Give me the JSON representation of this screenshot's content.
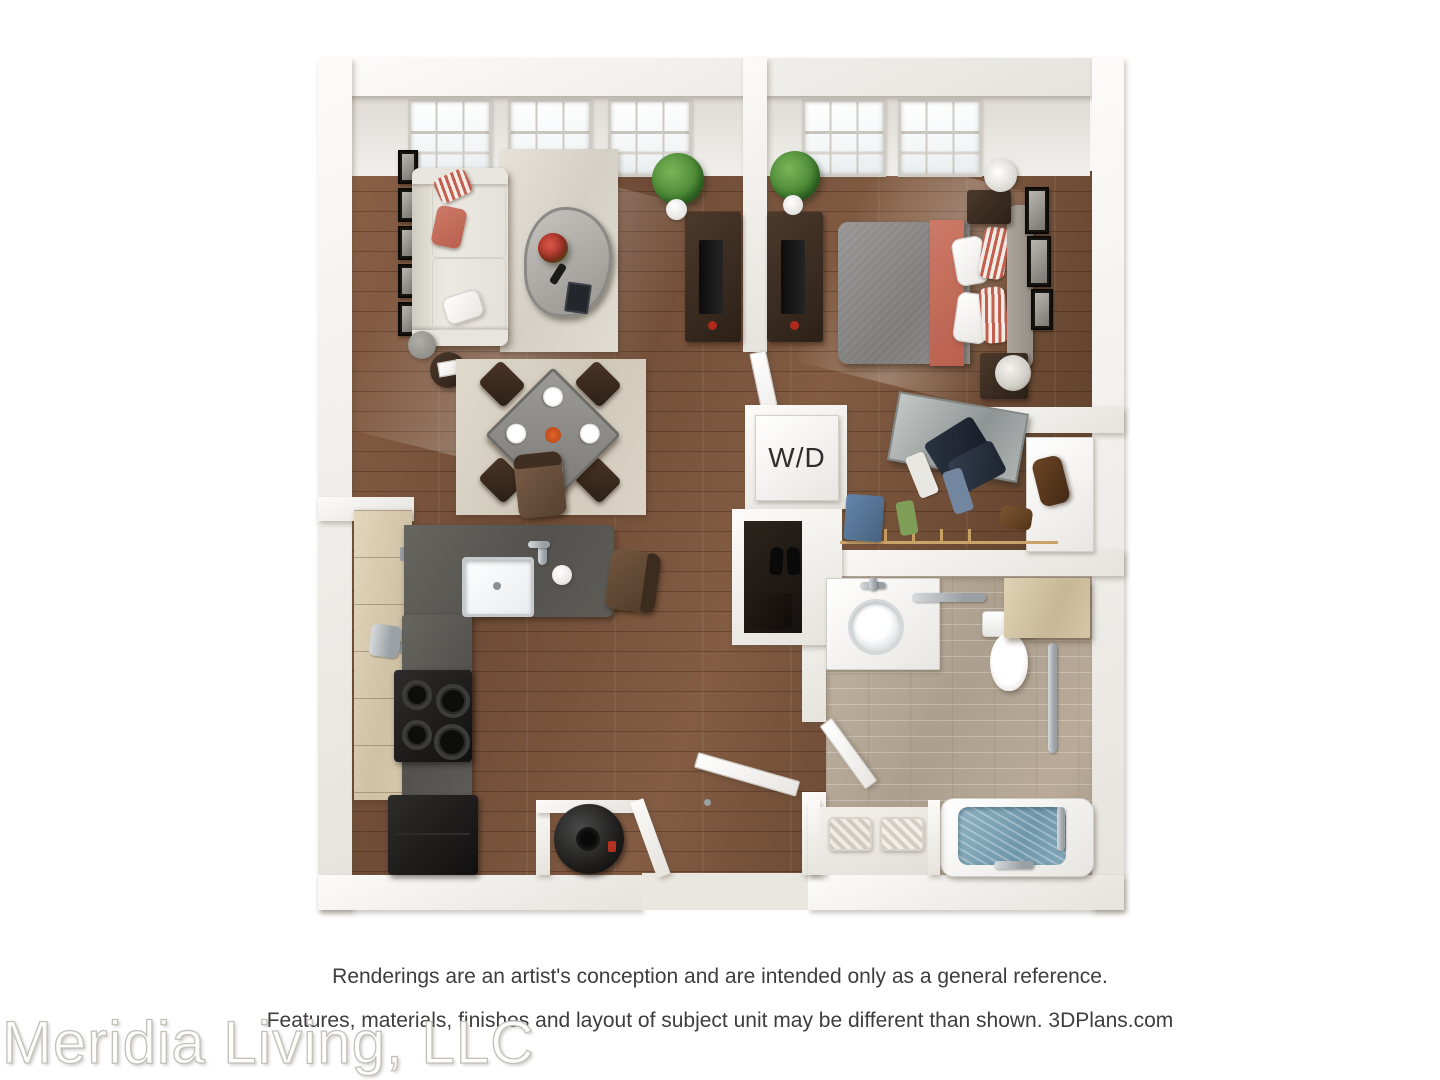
{
  "watermark": "Meridia Living, LLC",
  "disclaimer": {
    "line1": "Renderings are an artist's conception and are intended only as a general reference.",
    "line2": "Features, materials, finishes and layout of subject unit may be different than shown. 3DPlans.com"
  },
  "plan": {
    "labels": {
      "washer_dryer": "W/D"
    },
    "view": "3D top-down apartment floor plan rendering, one bedroom / one bathroom unit",
    "rooms": [
      "living room",
      "dining area",
      "kitchen",
      "bedroom",
      "hallway",
      "walk-in closet",
      "coat closet",
      "laundry closet",
      "bathroom",
      "linen closet",
      "water heater closet",
      "entry"
    ],
    "furniture": [
      "sofa with coral pillow",
      "glass coffee table with red flowers",
      "living room rug",
      "round side table",
      "gallery wall frames",
      "dining table with four chairs and place settings",
      "dining rug",
      "two potted plants",
      "tv console living side",
      "tv console bedroom side",
      "queen bed with gray duvet and coral runner",
      "upholstered headboard",
      "two nightstands with lamps",
      "three wall frames",
      "washer dryer unit",
      "hanging clothes and shoes",
      "brown handbag",
      "sliding mirror door",
      "light wood kitchen cabinets",
      "L-shaped gray counter with sink",
      "black range with four burners",
      "black refrigerator",
      "two bar stools",
      "chrome kettle",
      "bathroom vanity with round sink",
      "toilet",
      "wood cabinet over toilet",
      "chrome grab bars",
      "bathtub with water",
      "two towel baskets",
      "black water heater",
      "entry door"
    ],
    "colors": {
      "wood_floor": "#7a563e",
      "bathroom_tile": "#b9ac9b",
      "wall": "#f6f4f1",
      "counter": "#5d5c58",
      "cabinets": "#dccfb6",
      "appliances": "#1a1817",
      "sofa": "#e9e6df",
      "accent_coral": "#c4705f",
      "bed_gray": "#8d8c8a",
      "rug": "#ded9d1",
      "plant_green": "#4e8a3a",
      "tub_water": "#84a9bb"
    }
  }
}
